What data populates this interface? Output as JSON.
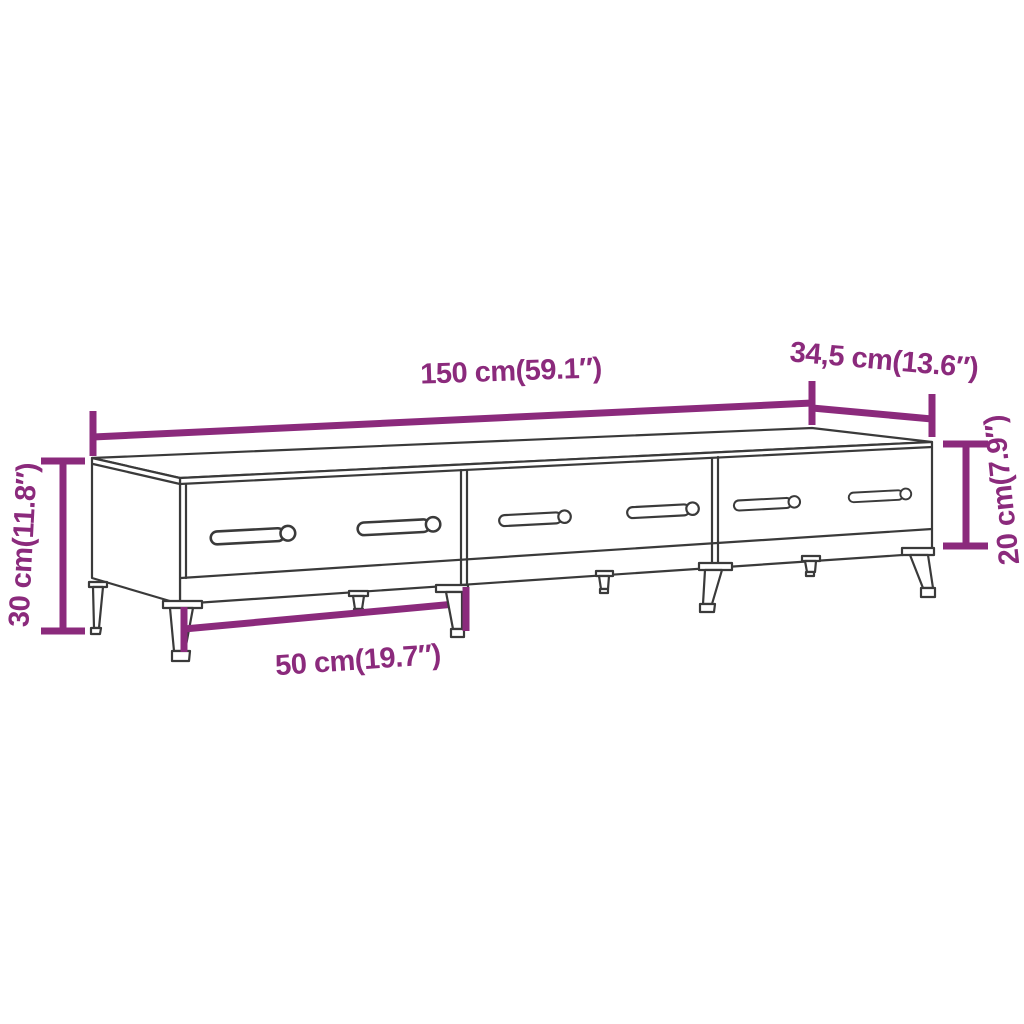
{
  "labels": {
    "width": "150 cm(59.1″)",
    "depth": "34,5 cm(13.6″)",
    "height_total": "30 cm(11.8″)",
    "height_cabinet": "20 cm(7.9″)",
    "drawer_width": "50 cm(19.7″)"
  },
  "colors": {
    "dimension_accent": "#8B2A7C",
    "furniture_outline": "#3A3A3A",
    "background": "#FFFFFF"
  }
}
